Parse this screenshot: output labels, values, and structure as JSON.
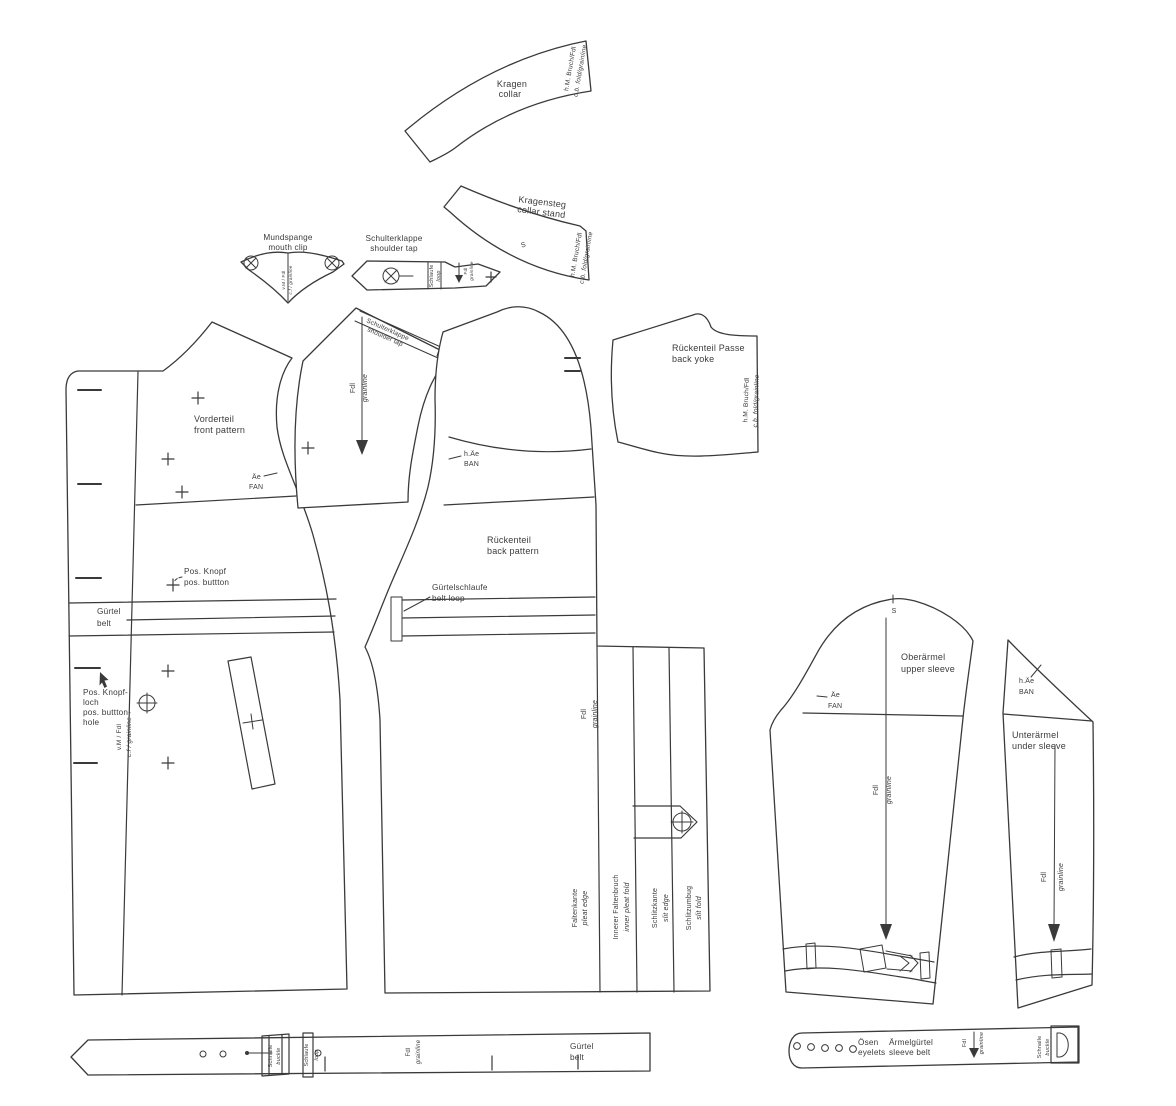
{
  "colors": {
    "ink": "#3a3a3a",
    "background": "#ffffff"
  },
  "labels": {
    "collar": {
      "de": "Kragen",
      "en": "collar"
    },
    "collar_stand": {
      "de": "Kragensteg",
      "en": "collar stand"
    },
    "mouth_clip": {
      "de": "Mundspange",
      "en": "mouth clip"
    },
    "shoulder_tab": {
      "de": "Schulterklappe",
      "en": "shoulder tap"
    },
    "front": {
      "de": "Vorderteil",
      "en": "front pattern"
    },
    "back": {
      "de": "Rückenteil",
      "en": "back pattern"
    },
    "back_yoke": {
      "de": "Rückenteil Passe",
      "en": "back yoke"
    },
    "belt": {
      "de": "Gürtel",
      "en": "belt"
    },
    "belt_loop": {
      "de": "Gürtelschlaufe",
      "en": "belt loop"
    },
    "upper_sleeve": {
      "de": "Oberärmel",
      "en": "upper sleeve"
    },
    "under_sleeve": {
      "de": "Unterärmel",
      "en": "under sleeve"
    },
    "sleeve_belt": {
      "de": "Ärmelgürtel",
      "en": "sleeve belt"
    },
    "eyelets": {
      "de": "Ösen",
      "en": "eyelets"
    },
    "buckle": {
      "de": "Schnalle",
      "en": "buckle"
    },
    "loop": {
      "de": "Schlaufe",
      "en": "loop"
    },
    "pleat_edge": {
      "de": "Faltenkante",
      "en": "pleat edge"
    },
    "inner_pleat_fold": {
      "de": "Innerer Faltenbruch",
      "en": "inner pleat fold"
    },
    "slit_edge": {
      "de": "Schlitzkante",
      "en": "slit edge"
    },
    "slit_fold": {
      "de": "Schlitzumbug",
      "en": "slit fold"
    },
    "pos_button": {
      "de": "Pos. Knopf",
      "en": "pos. buttton"
    },
    "pos_buttonhole": {
      "de1": "Pos. Knopf-",
      "de2": "loch",
      "en1": "pos. buttton-",
      "en2": "hole"
    },
    "grainline": {
      "de": "Fdl",
      "en": "grainline"
    },
    "cb_fold": {
      "de": "h.M. Bruch/Fdl",
      "en": "c.b. fold/grainline"
    },
    "cf_line": {
      "de": "v.M / Fdl",
      "en": "c.f / grainline"
    },
    "front_armhole_notch": {
      "de": "Äe",
      "en": "FAN"
    },
    "back_armhole_notch": {
      "de": "h.Äe",
      "en": "BAN"
    },
    "notch_s": "S"
  }
}
